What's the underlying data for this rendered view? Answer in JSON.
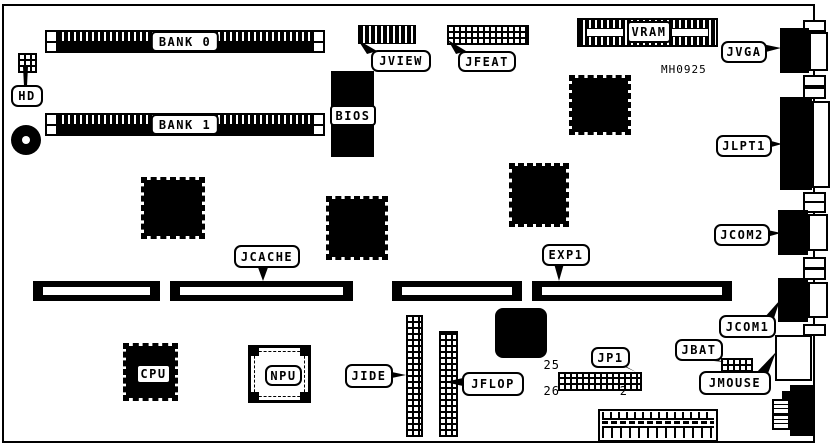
{
  "diagram": {
    "board_id": "MH0925",
    "labels": {
      "bank0": "BANK 0",
      "bank1": "BANK 1",
      "hd": "HD",
      "jview": "JVIEW",
      "jfeat": "JFEAT",
      "bios": "BIOS",
      "vram": "VRAM",
      "jvga": "JVGA",
      "jlpt1": "JLPT1",
      "jcom2": "JCOM2",
      "jcom1": "JCOM1",
      "jbat": "JBAT",
      "jmouse": "JMOUSE",
      "jcache": "JCACHE",
      "exp1": "EXP1",
      "jp1": "JP1",
      "cpu": "CPU",
      "npu": "NPU",
      "jide": "JIDE",
      "jflop": "JFLOP"
    },
    "jp1_pin_numbers": {
      "top_left": "25",
      "bottom_left": "26",
      "bottom_right": "2"
    },
    "colors": {
      "line": "#000000",
      "background": "#ffffff"
    }
  }
}
